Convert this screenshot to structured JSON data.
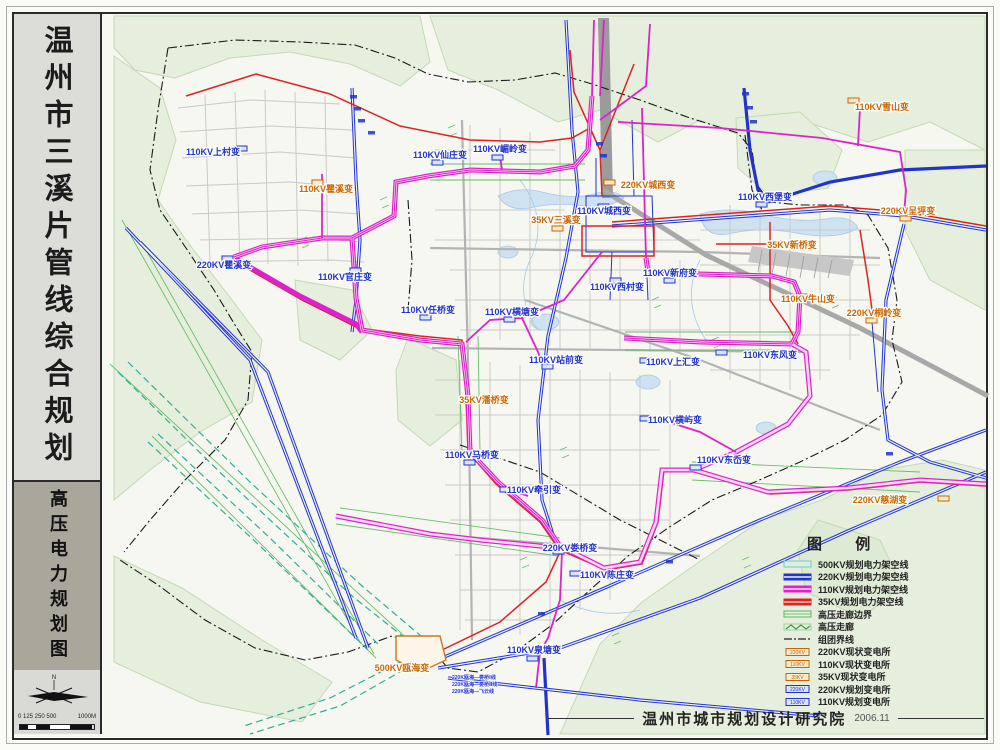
{
  "sidebar": {
    "title": "温州市三溪片管线综合规划",
    "subtitle": "高压电力规划图",
    "compass": "N",
    "scale_ticks": "0 125 250 500",
    "scale_end": "1000M"
  },
  "legend": {
    "title": "图 例",
    "items": [
      {
        "label": "500KV规划电力架空线",
        "type": "line-500kv",
        "color": "#bfe8d8"
      },
      {
        "label": "220KV规划电力架空线",
        "type": "line-220kv",
        "color": "#2233cc"
      },
      {
        "label": "110KV规划电力架空线",
        "type": "line-110kv",
        "color": "#dd22cc"
      },
      {
        "label": "35KV规划电力架空线",
        "type": "line-35kv",
        "color": "#dd2222"
      },
      {
        "label": "高压走廊边界",
        "type": "corridor-boundary",
        "color": "#5cb85c"
      },
      {
        "label": "高压走廊",
        "type": "corridor",
        "color": "#5cb85c"
      },
      {
        "label": "组团界线",
        "type": "cluster-boundary",
        "color": "#333333"
      },
      {
        "label": "220KV现状变电所",
        "type": "station-existing",
        "box": "220KV",
        "color": "#c86400"
      },
      {
        "label": "110KV现状变电所",
        "type": "station-existing",
        "box": "110KV",
        "color": "#c86400"
      },
      {
        "label": "35KV现状变电所",
        "type": "station-existing",
        "box": "35KV",
        "color": "#c86400"
      },
      {
        "label": "220KV规划变电所",
        "type": "station-planned",
        "box": "220KV",
        "color": "#2233cc"
      },
      {
        "label": "110KV规划变电所",
        "type": "station-planned",
        "box": "110KV",
        "color": "#2233cc"
      }
    ]
  },
  "credit": {
    "org": "温州市城市规划设计研究院",
    "date": "2006.11"
  },
  "map": {
    "substations": [
      {
        "name": "110KV上村变",
        "status": "planned"
      },
      {
        "name": "110KV瞿溪变",
        "status": "existing"
      },
      {
        "name": "220KV瞿溪变",
        "status": "planned"
      },
      {
        "name": "110KV官庄变",
        "status": "planned"
      },
      {
        "name": "110KV仙庄变",
        "status": "planned"
      },
      {
        "name": "110KV嵋岭变",
        "status": "planned"
      },
      {
        "name": "220KV城西变",
        "status": "existing"
      },
      {
        "name": "110KV城西变",
        "status": "planned"
      },
      {
        "name": "35KV三溪变",
        "status": "existing"
      },
      {
        "name": "110KV西村变",
        "status": "planned"
      },
      {
        "name": "110KV新府变",
        "status": "planned"
      },
      {
        "name": "110KV雪山变",
        "status": "existing"
      },
      {
        "name": "110KV西堡变",
        "status": "planned"
      },
      {
        "name": "220KV呈坪变",
        "status": "existing"
      },
      {
        "name": "35KV新桥变",
        "status": "existing"
      },
      {
        "name": "110KV牛山变",
        "status": "existing"
      },
      {
        "name": "220KV桐岭变",
        "status": "existing"
      },
      {
        "name": "110KV任桥变",
        "status": "planned"
      },
      {
        "name": "110KV横塘变",
        "status": "planned"
      },
      {
        "name": "110KV站前变",
        "status": "planned"
      },
      {
        "name": "110KV上汇变",
        "status": "planned"
      },
      {
        "name": "110KV东风变",
        "status": "planned"
      },
      {
        "name": "110KV横屿变",
        "status": "planned"
      },
      {
        "name": "35KV潘桥变",
        "status": "existing"
      },
      {
        "name": "110KV马桥变",
        "status": "planned"
      },
      {
        "name": "110KV牵引变",
        "status": "planned"
      },
      {
        "name": "220KV娄桥变",
        "status": "planned"
      },
      {
        "name": "110KV陈庄变",
        "status": "planned"
      },
      {
        "name": "110KV泉塘变",
        "status": "planned"
      },
      {
        "name": "500KV瓯海变",
        "status": "existing"
      },
      {
        "name": "110KV东岙变",
        "status": "planned"
      },
      {
        "name": "220KV慈湖变",
        "status": "existing"
      }
    ],
    "line_labels": [
      "220K瓯海—娄桥Ⅰ线",
      "220K瓯海—娄桥Ⅱ线",
      "220K瓯海—飞云线"
    ]
  }
}
